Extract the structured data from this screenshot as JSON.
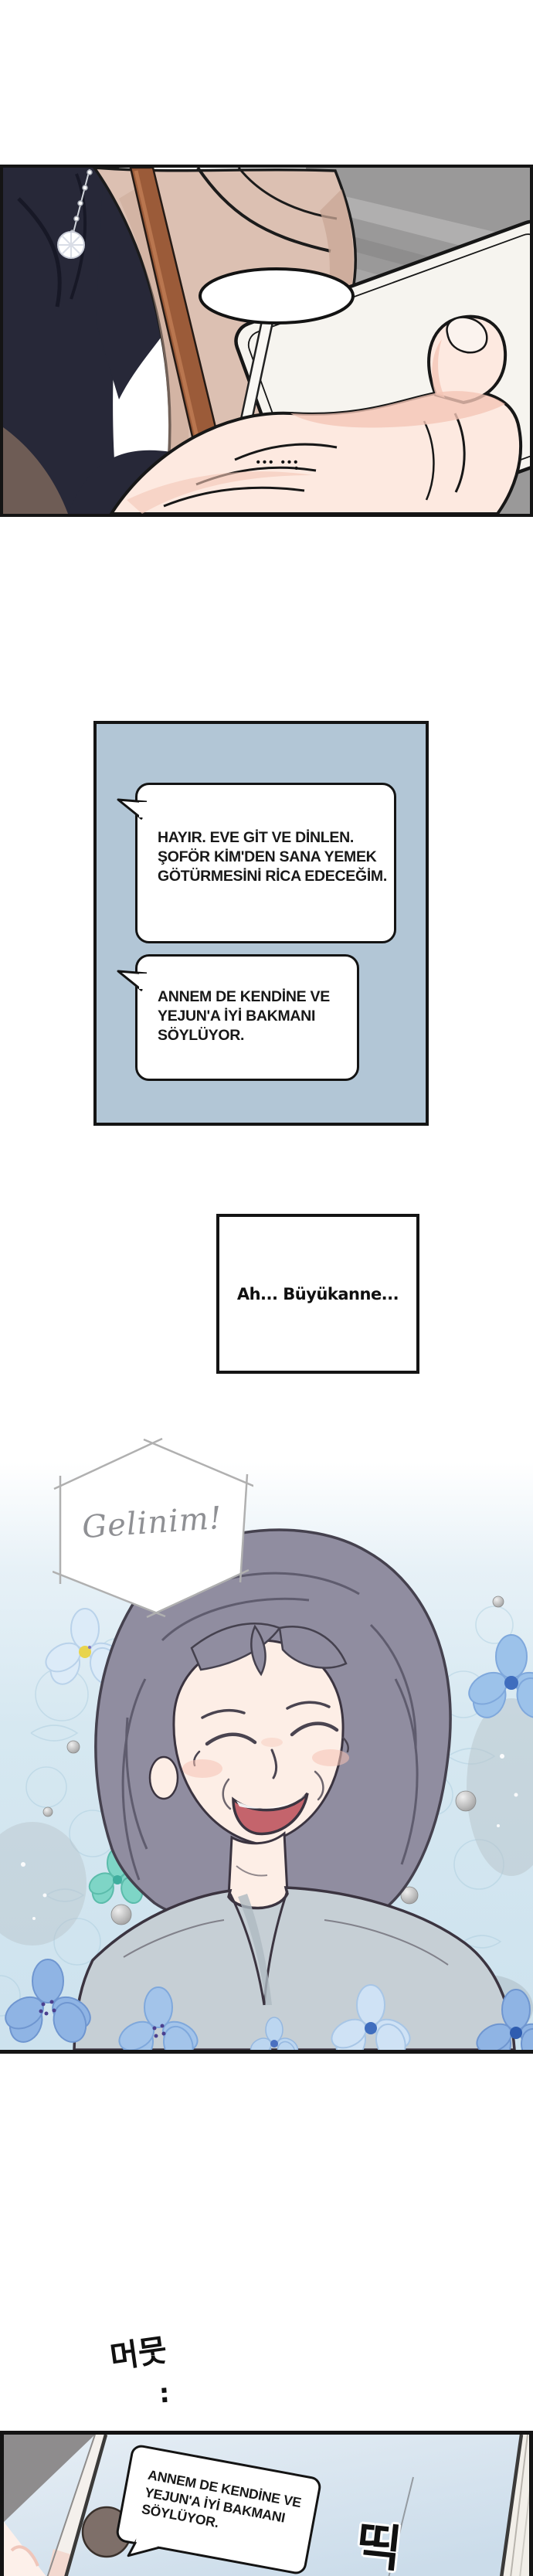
{
  "comic": {
    "panel_top": {
      "speech_dots": "••• •••",
      "speech_dot_extra": "•"
    },
    "chat_panel": {
      "bubble1": "HAYIR. EVE GİT VE DİNLEN.\nŞOFÖR KİM'DEN SANA YEMEK\nGÖTÜRMESİNİ RİCA EDECEĞİM.",
      "bubble2": "ANNEM DE KENDİNE VE\nYEJUN'A İYİ BAKMANI\nSÖYLÜYOR."
    },
    "caption": "Ah... Büyükanne...",
    "shout": "Gelinim!",
    "sfx_hesitate": "머뭇",
    "sfx_hesitate_dots": ":",
    "sfx_beep": "띡",
    "tablet_panel": {
      "bubble": "ANNEM DE KENDİNE VE\nYEJUN'A İYİ BAKMANI\nSÖYLÜYOR."
    }
  },
  "colors": {
    "panel_border": "#141414",
    "chat_panel_bg": "#b2c6d6",
    "jacket_beige": "#dcc0b2",
    "shirt_navy": "#272838",
    "strap_brown": "#9b5b39",
    "background_grey": "#9a9999",
    "tablet_white": "#f6f4ef",
    "skin": "#fde9e0",
    "illustration_blue": "#d6e8f1",
    "hair_grey": "#908da0",
    "garment_grey": "#c6cfd5",
    "screen_blue": "#dbe7f0",
    "avatar_brown": "#7e6f69",
    "shout_text_grey": "#8f9094"
  }
}
